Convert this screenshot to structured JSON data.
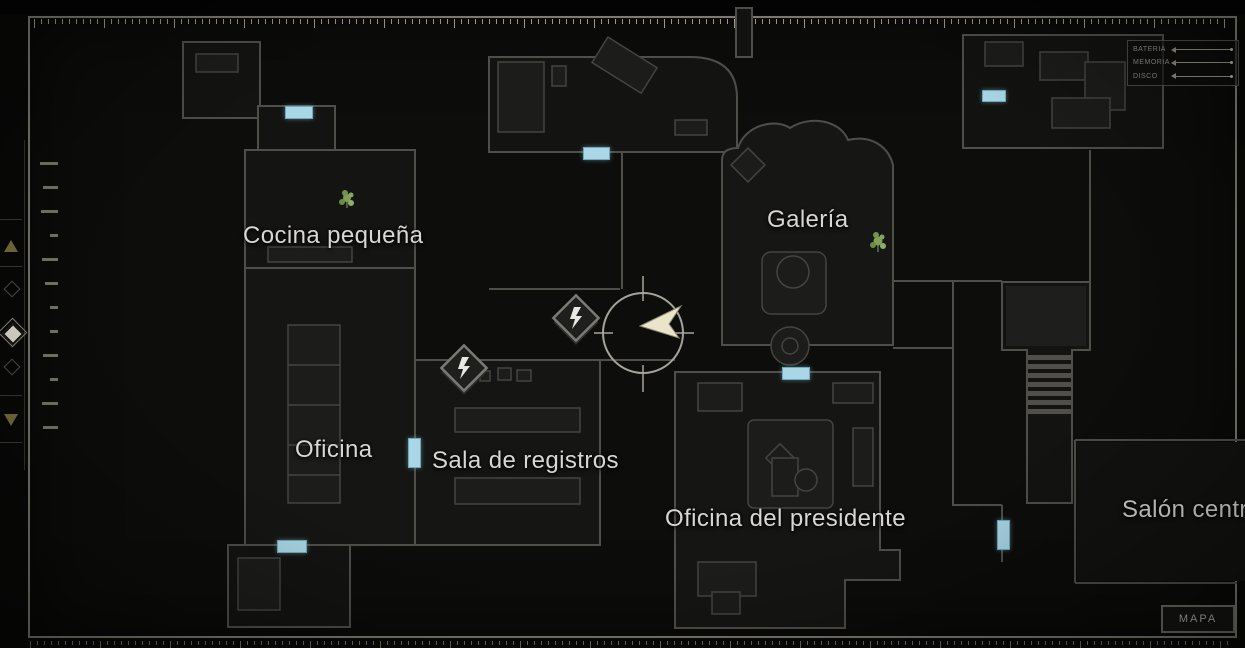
{
  "screen": {
    "mode_badge": "MAPA"
  },
  "rooms": [
    {
      "label": "Cocina pequeña"
    },
    {
      "label": "Galería"
    },
    {
      "label": "Oficina"
    },
    {
      "label": "Sala de registros"
    },
    {
      "label": "Oficina del presidente"
    },
    {
      "label": "Salón central"
    }
  ],
  "legend": {
    "items": [
      {
        "label": "BATERÍA"
      },
      {
        "label": "MEMORIA"
      },
      {
        "label": "DISCO"
      }
    ]
  },
  "floor_selector": {
    "up_icon": "",
    "down_icon": ""
  },
  "colors": {
    "door_marker": "#a9d7e6",
    "player_arrow": "#eae4cb",
    "room_label": "#d8d7d3",
    "wall": "#4f4e49",
    "frame": "#7b7971",
    "plant": "#7fa055",
    "selector_arrow": "#7b7140",
    "selector_selected": "#e8e6da"
  }
}
